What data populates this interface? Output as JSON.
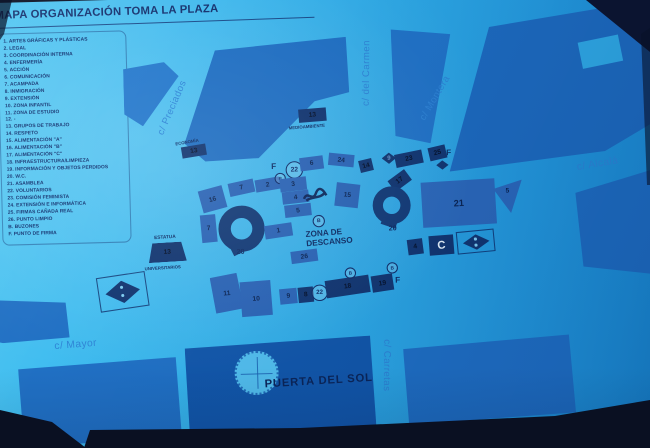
{
  "title": "MAPA ORGANIZACIÓN TOMA LA PLAZA",
  "legend": {
    "items": [
      "1. ARTES GRÁFICAS Y PLÁSTICAS",
      "2. LEGAL",
      "3. COORDINACIÓN  INTERNA",
      "4. ENFERMERÍA",
      "5. ACCIÓN",
      "6. COMUNICACIÓN",
      "7. ACAMPADA",
      "8. INMIGRACIÓN",
      "9. EXTENSIÓN",
      "10. ZONA INFANTIL",
      "11. ZONA DE ESTUDIO",
      "12. -",
      "13. GRUPOS DE TRABAJO",
      "14. RESPETO",
      "15. ALIMENTACIÓN \"A\"",
      "16. ALIMENTACIÓN \"B\"",
      "17. ALIMENTACIÓN \"C\"",
      "18. INFRAESTRUCTURA/LIMPIEZA",
      "19. INFORMACIÓN Y OBJETOS PERDIDOS",
      "20. W.C.",
      "21. ASAMBLEA",
      "22. VOLUNTARIOS",
      "23. COMISIÓN FEMINISTA",
      "24. EXTENSIÓN E INFORMÁTICA",
      "25. FIRMAS CAÑADA REAL",
      "26. PUNTO LIMPIO",
      "B. BUZONES",
      "F. PUNTO DE FIRMA"
    ]
  },
  "streets": {
    "preciados": "c/ Preciados",
    "carmen": "c/ del Carmen",
    "montera": "c/ Montera",
    "alcala": "c/ Alcalá",
    "mayor": "c/ Mayor",
    "carretas": "c/ Carretas"
  },
  "map": {
    "zona_descanso_line1": "ZONA DE",
    "zona_descanso_line2": "DESCANSO",
    "puerta_del_sol": "PUERTA DEL SOL",
    "estatua": "ESTATUA",
    "universitarios": "UNIVERSITARIOS",
    "economia": "ECONOMÍA",
    "medioambiente": "MEDIOAMBIENTE",
    "stands": {
      "s13a": "13",
      "s13b": "13",
      "s13c": "13",
      "s16": "16",
      "s7a": "7",
      "s2": "2",
      "s7b": "7",
      "s3": "3",
      "s4": "4",
      "s5": "5",
      "s6": "6",
      "s24": "24",
      "s15": "15",
      "s14": "14",
      "d9": "9",
      "s23": "23",
      "s25": "25",
      "s17": "17",
      "s1": "1",
      "s26": "26",
      "s11": "11",
      "s10": "10",
      "s9": "9",
      "s8": "8",
      "s18": "18",
      "s19": "19",
      "s4b": "4",
      "s21": "21",
      "tri5": "5",
      "cbox": "C",
      "ring_left": "20",
      "ring_right": "20",
      "c22": "22",
      "cb": "B",
      "f": "F"
    }
  },
  "colors": {
    "paper_cyan": "#2fb0e8",
    "building_blue": "#1f70c4",
    "stand_dark_navy": "#113570",
    "stand_medium_blue": "#2a64b6",
    "dark_photo_background": "#0a1124",
    "legend_text_navy": "#0d2f6e"
  }
}
